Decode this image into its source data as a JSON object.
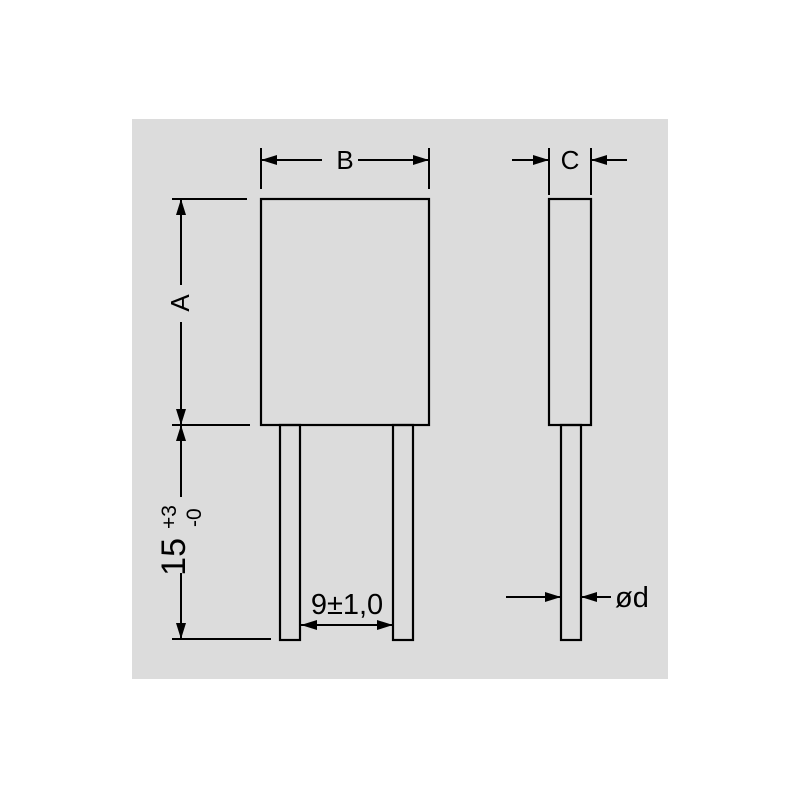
{
  "diagram": {
    "colors": {
      "canvas": "#ffffff",
      "panel": "#dcdcdc",
      "line": "#000000"
    },
    "labels": {
      "body_height": "A",
      "body_width": "B",
      "body_thickness": "C",
      "lead_length": "15",
      "lead_length_upper_tol": "+3",
      "lead_length_lower_tol": "-0",
      "lead_pitch": "9±1,0",
      "lead_diameter": "ød"
    }
  }
}
